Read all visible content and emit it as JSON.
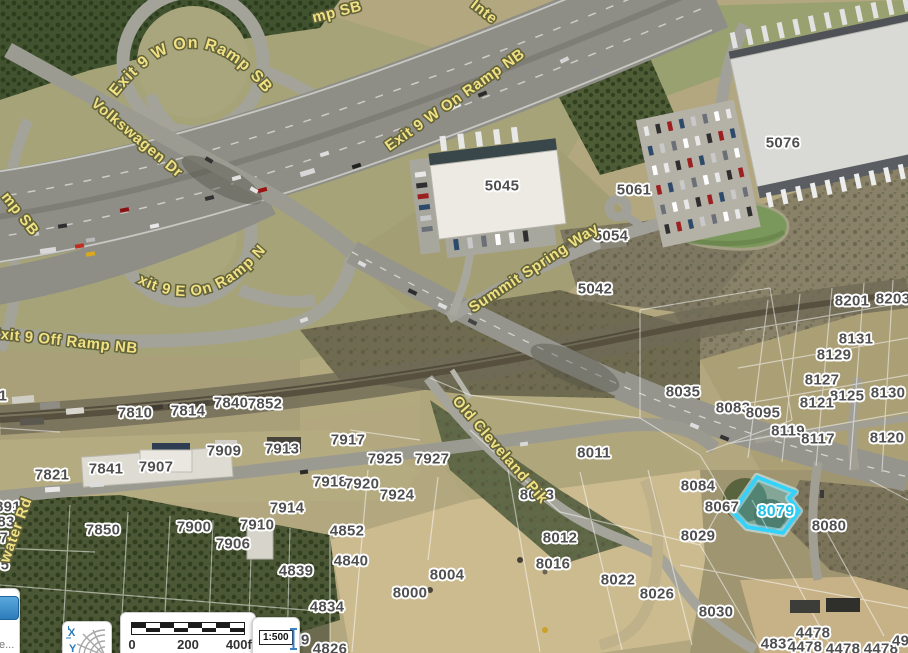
{
  "map": {
    "label_colors": {
      "parcel_text": "#4f4f4f",
      "road_text": "#f1e183"
    },
    "parcel_labels": [
      {
        "text": "5076",
        "x": 783,
        "y": 143
      },
      {
        "text": "5045",
        "x": 502,
        "y": 186
      },
      {
        "text": "5061",
        "x": 634,
        "y": 190
      },
      {
        "text": "5054",
        "x": 611,
        "y": 236
      },
      {
        "text": "5042",
        "x": 595,
        "y": 289
      },
      {
        "text": "8201",
        "x": 852,
        "y": 301
      },
      {
        "text": "8203",
        "x": 893,
        "y": 299
      },
      {
        "text": "8131",
        "x": 856,
        "y": 339
      },
      {
        "text": "8129",
        "x": 834,
        "y": 355
      },
      {
        "text": "8127",
        "x": 822,
        "y": 380
      },
      {
        "text": "8125",
        "x": 847,
        "y": 396
      },
      {
        "text": "8121",
        "x": 817,
        "y": 403
      },
      {
        "text": "8130",
        "x": 888,
        "y": 393
      },
      {
        "text": "8035",
        "x": 683,
        "y": 392
      },
      {
        "text": "8083",
        "x": 733,
        "y": 408
      },
      {
        "text": "8095",
        "x": 763,
        "y": 413
      },
      {
        "text": "8119",
        "x": 788,
        "y": 431
      },
      {
        "text": "8117",
        "x": 818,
        "y": 439
      },
      {
        "text": "8120",
        "x": 887,
        "y": 438
      },
      {
        "text": "8084",
        "x": 698,
        "y": 486
      },
      {
        "text": "8067",
        "x": 722,
        "y": 507
      },
      {
        "text": "8080",
        "x": 829,
        "y": 526
      },
      {
        "text": "8029",
        "x": 698,
        "y": 536
      },
      {
        "text": "8011",
        "x": 594,
        "y": 453
      },
      {
        "text": "8013",
        "x": 537,
        "y": 495
      },
      {
        "text": "8012",
        "x": 560,
        "y": 538
      },
      {
        "text": "8016",
        "x": 553,
        "y": 564
      },
      {
        "text": "8022",
        "x": 618,
        "y": 580
      },
      {
        "text": "8026",
        "x": 657,
        "y": 594
      },
      {
        "text": "8030",
        "x": 716,
        "y": 612
      },
      {
        "text": "8004",
        "x": 447,
        "y": 575
      },
      {
        "text": "8000",
        "x": 410,
        "y": 593
      },
      {
        "text": "4852",
        "x": 347,
        "y": 531
      },
      {
        "text": "4840",
        "x": 351,
        "y": 561
      },
      {
        "text": "4839",
        "x": 296,
        "y": 571
      },
      {
        "text": "4834",
        "x": 327,
        "y": 607
      },
      {
        "text": "4826",
        "x": 330,
        "y": 649
      },
      {
        "text": "4832",
        "x": 778,
        "y": 644
      },
      {
        "text": "4478",
        "x": 813,
        "y": 633
      },
      {
        "text": "4478",
        "x": 805,
        "y": 647
      },
      {
        "text": "4478",
        "x": 843,
        "y": 649
      },
      {
        "text": "4478",
        "x": 881,
        "y": 649
      },
      {
        "text": "491",
        "x": 905,
        "y": 641
      },
      {
        "text": "7924",
        "x": 397,
        "y": 495
      },
      {
        "text": "7918",
        "x": 330,
        "y": 482
      },
      {
        "text": "7920",
        "x": 362,
        "y": 484
      },
      {
        "text": "7925",
        "x": 385,
        "y": 459
      },
      {
        "text": "7927",
        "x": 432,
        "y": 459
      },
      {
        "text": "7917",
        "x": 348,
        "y": 440
      },
      {
        "text": "7913",
        "x": 282,
        "y": 449
      },
      {
        "text": "7909",
        "x": 224,
        "y": 451
      },
      {
        "text": "7907",
        "x": 156,
        "y": 467
      },
      {
        "text": "7841",
        "x": 106,
        "y": 469
      },
      {
        "text": "7821",
        "x": 52,
        "y": 475
      },
      {
        "text": "7810",
        "x": 135,
        "y": 413
      },
      {
        "text": "7814",
        "x": 188,
        "y": 411
      },
      {
        "text": "7840",
        "x": 231,
        "y": 403
      },
      {
        "text": "7852",
        "x": 265,
        "y": 404
      },
      {
        "text": "7850",
        "x": 103,
        "y": 530
      },
      {
        "text": "7900",
        "x": 194,
        "y": 527
      },
      {
        "text": "7910",
        "x": 257,
        "y": 525
      },
      {
        "text": "7906",
        "x": 233,
        "y": 544
      },
      {
        "text": "7914",
        "x": 287,
        "y": 508
      },
      {
        "text": "29",
        "x": 301,
        "y": 640
      },
      {
        "text": "891",
        "x": 8,
        "y": 507
      },
      {
        "text": "83",
        "x": 6,
        "y": 522
      },
      {
        "text": "7",
        "x": 4,
        "y": 538
      },
      {
        "text": "5",
        "x": 5,
        "y": 565
      },
      {
        "text": "1",
        "x": 3,
        "y": 396
      }
    ],
    "road_labels": [
      {
        "text": "mp SB",
        "x": 337,
        "y": 12,
        "rotate": -14
      },
      {
        "text": "Inte",
        "x": 484,
        "y": 12,
        "rotate": 38
      },
      {
        "text": "Exit 9 W On Ramp NB",
        "x": 455,
        "y": 100,
        "rotate": -35
      },
      {
        "text": "Volkswagen Dr",
        "x": 137,
        "y": 138,
        "rotate": 40
      },
      {
        "text": "mp SB",
        "x": 20,
        "y": 214,
        "rotate": 52
      },
      {
        "text": "Exit 9 Off Ramp NB",
        "x": 64,
        "y": 341,
        "rotate": 6
      },
      {
        "text": "Summit Spring Way",
        "x": 534,
        "y": 268,
        "rotate": -33
      },
      {
        "text": "Old Cleveland Pik",
        "x": 500,
        "y": 450,
        "rotate": 49
      },
      {
        "text": "water Rd",
        "x": 16,
        "y": 530,
        "rotate": -70
      }
    ],
    "curved_road_labels": [
      {
        "text": "Exit 9 W  On Ramp  SB"
      },
      {
        "text": "Exit 9 E On  Ramp NB"
      }
    ],
    "selected_parcel": {
      "id": "8079",
      "label_x": 776,
      "label_y": 512,
      "points": "733,512 757,477 795,492 789,498 799,511 783,533 747,527",
      "outline_color": "#2fd3fc",
      "glow_color": "#c9f3ff",
      "fill_color": "rgba(70,205,240,0.30)",
      "label_color": "#1fc0e8"
    }
  },
  "controls": {
    "partial_panel": {
      "text": "e...",
      "icon": "blue-tool-icon"
    },
    "xy_button": {
      "x_label": "X",
      "y_label": "Y",
      "icon": "globe-grid-icon"
    },
    "scale_bar": {
      "ticks": [
        "0",
        "200",
        "400ft"
      ]
    },
    "scale_indicator": {
      "value": "1:500",
      "icon": "scale-ibeam-icon"
    }
  }
}
